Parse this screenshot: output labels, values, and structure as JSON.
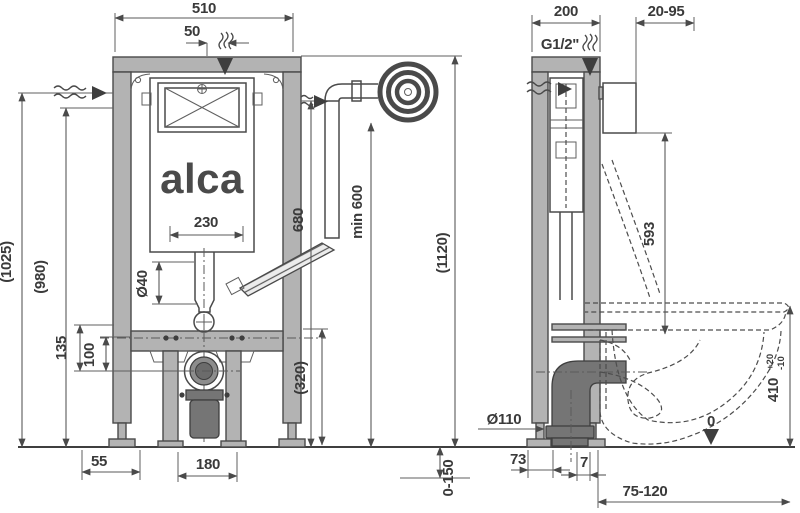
{
  "drawing_type": "installation-frame-technical-drawing",
  "labels": {
    "logo": "alca",
    "front": {
      "w510": "510",
      "w50": "50",
      "h1025": "(1025)",
      "h980": "(980)",
      "d135": "135",
      "d100": "100",
      "w230": "230",
      "dia40": "Ø40",
      "d320": "(320)",
      "d680": "680",
      "min600": "min 600",
      "h1120": "(1120)",
      "d55": "55",
      "d180": "180"
    },
    "side": {
      "d200": "200",
      "wall_range": "20-95",
      "thread": "G1/2\"",
      "d593": "593",
      "dia110": "Ø110",
      "d73": "73",
      "d7": "7",
      "outlet_range": "75-120",
      "floor_range": "0-150",
      "seat_height": "410",
      "tol_plus": "+20",
      "tol_minus": "-10",
      "datum_zero": "0"
    }
  },
  "colors": {
    "background": "#ffffff",
    "line": "#4a4a4a",
    "profile_fill": "#b3b3b3",
    "dark_fill": "#757575",
    "text": "#3a3a3a"
  }
}
